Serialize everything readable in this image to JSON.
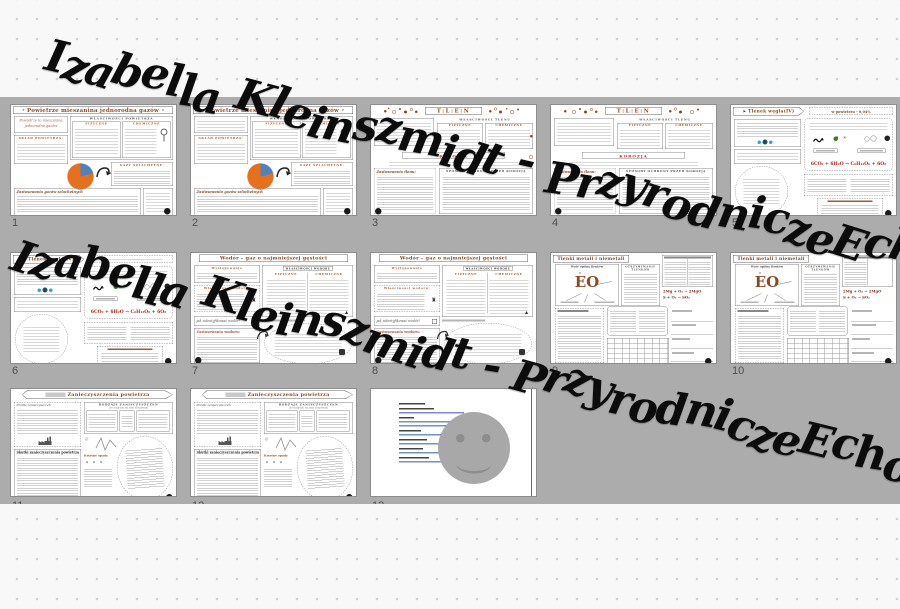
{
  "watermarks": [
    {
      "text": "Izabella Kleinszmidt - PrzyrodniczeEcho"
    },
    {
      "text": "Izabella Kleinszmidt - PrzyrodniczeEcho"
    }
  ],
  "labels": {
    "fizyczne": "FIZYCZNE",
    "chemiczne": "CHEMICZNE"
  },
  "worksheets": {
    "powietrze": {
      "title": "Powietrze mieszanina jednorodna gazów",
      "intro": "Powietrze to mieszanina jednorodna gazów",
      "wlasciwosci": "WŁAŚCIWOŚCI POWIETRZA",
      "sklad": "SKŁAD POWIETRZA:",
      "gazy": "GAZY SZLACHETNE:",
      "zastosowania": "Zastosowania gazów szlachetnych"
    },
    "tlen": {
      "title": "T:L:E:N",
      "wlasciwosci": "WŁAŚCIWOŚCI TLENU",
      "korozja": "KOROZJA",
      "zastosowania": "Zastosowania tlenu:",
      "sposoby": "SPOSOBY OCHRONY PRZED KOROZJĄ"
    },
    "tlenek": {
      "title": "Tlenek węgla(IV)",
      "powietrze_pct": "w powietrzu - 0,04%",
      "rownanie": "6CO₂ + 6H₂O → C₆H₁₂O₆ + 6O₂"
    },
    "wodor": {
      "title": "Wodór – gaz o najmniejszej gęstości",
      "wystepowanie": "Występowanie",
      "wlasciwosci": "WŁAŚCIWOŚCI WODORU",
      "wlasciwosci_lewa": "Właściwości wodoru:",
      "identyfikacja": "jak zidentyfikować wodór?",
      "zastosowania": "Zastosowania wodoru:"
    },
    "tlenki": {
      "title": "Tlenki metali i niemetali",
      "wzor_ogolny": "Wzór ogólny tlenków",
      "eo": "EO",
      "eo_mark": "II",
      "otrzymywanie": "OTRZYMYWANIE TLENKÓW",
      "rownania": [
        "2Mg + O₂ → 2MgO",
        "S + O₂ → SO₂"
      ]
    },
    "zanieczyszczenia": {
      "title": "Zanieczyszczenia powietrza",
      "rodzaje": "RODZAJE ZANIECZYSZCZEŃ",
      "rodzaje_sub": "(ze względu na stan skupienia)",
      "zrodla": "Źródła zanieczyszczeń:",
      "skutki": "Skutki zanieczyszczenia powietrza",
      "kwasne": "Kwaśne opady"
    }
  },
  "thumbnails": [
    {
      "number": "1",
      "type": "powietrze",
      "variant": "filled"
    },
    {
      "number": "2",
      "type": "powietrze",
      "variant": "blank"
    },
    {
      "number": "3",
      "type": "tlen",
      "variant": "filled"
    },
    {
      "number": "4",
      "type": "tlen",
      "variant": "blank"
    },
    {
      "number": "5",
      "type": "tlenek",
      "variant": "filled"
    },
    {
      "number": "6",
      "type": "tlenek",
      "variant": "blank"
    },
    {
      "number": "7",
      "type": "wodor",
      "variant": "filled"
    },
    {
      "number": "8",
      "type": "wodor",
      "variant": "blank"
    },
    {
      "number": "9",
      "type": "tlenki",
      "variant": "filled"
    },
    {
      "number": "10",
      "type": "tlenki",
      "variant": "blank"
    },
    {
      "number": "11",
      "type": "zanieczyszczenia",
      "variant": "filled"
    },
    {
      "number": "12",
      "type": "zanieczyszczenia",
      "variant": "blank"
    },
    {
      "number": "13",
      "type": "links-page",
      "variant": "smiley"
    }
  ],
  "colors": {
    "band_gray": "#acacac",
    "accent_brown": "#8d4a22",
    "korozja_red": "#b02418",
    "pie_orange": "#e8701a",
    "pie_blue": "#4f81bd",
    "link_blue": "#7192c9",
    "guide_red": "#b94a3f"
  }
}
